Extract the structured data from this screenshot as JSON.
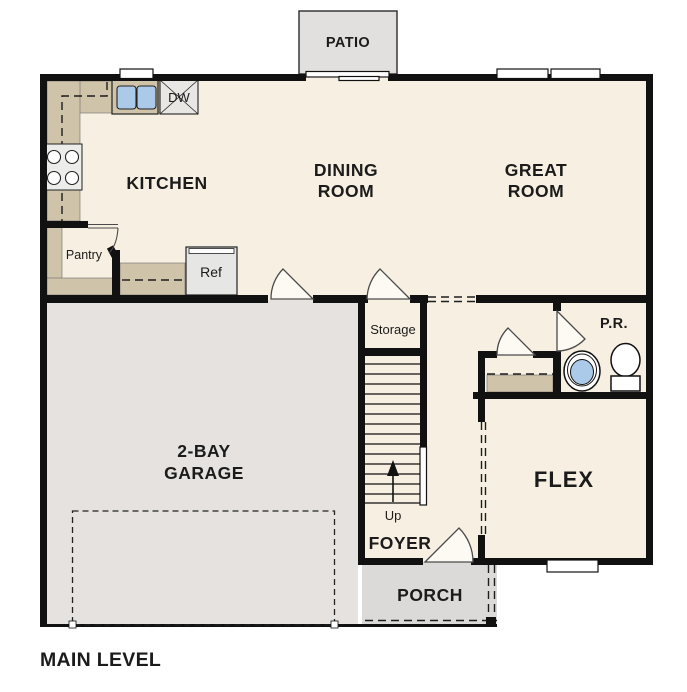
{
  "floor_plan": {
    "title": "MAIN LEVEL",
    "rooms": {
      "patio": {
        "label": "PATIO"
      },
      "kitchen": {
        "label": "KITCHEN"
      },
      "dining_room": {
        "label_line1": "DINING",
        "label_line2": "ROOM"
      },
      "great_room": {
        "label_line1": "GREAT",
        "label_line2": "ROOM"
      },
      "pantry": {
        "label": "Pantry"
      },
      "storage": {
        "label": "Storage"
      },
      "powder_room": {
        "label": "P.R."
      },
      "garage": {
        "label_line1": "2-BAY",
        "label_line2": "GARAGE"
      },
      "flex": {
        "label": "FLEX"
      },
      "foyer": {
        "label": "FOYER"
      },
      "porch": {
        "label": "PORCH"
      }
    },
    "fixtures": {
      "dishwasher": {
        "label": "DW"
      },
      "refrigerator": {
        "label": "Ref"
      },
      "stairs": {
        "direction_label": "Up"
      }
    },
    "colors": {
      "floor": "#f7f0e2",
      "garage_floor": "#e5e2df",
      "patio_floor": "#e2e0de",
      "porch_floor": "#dcdad8",
      "counter": "#cfc3a9",
      "wall": "#111111",
      "sink_blue": "#abc9e9"
    }
  }
}
